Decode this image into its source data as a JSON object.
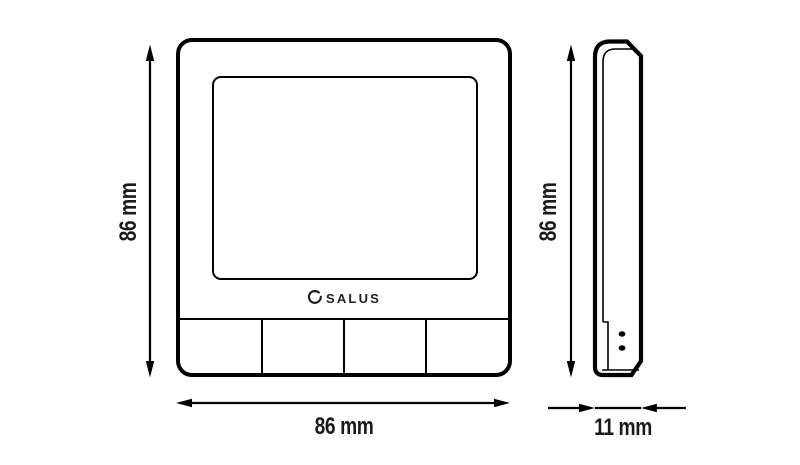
{
  "diagram": {
    "brand": "SALUS",
    "dimensions": {
      "front_height": "86 mm",
      "front_width": "86 mm",
      "side_height": "86 mm",
      "side_depth": "11 mm"
    },
    "front_view": {
      "button_count": 4
    },
    "colors": {
      "line": "#000000",
      "text": "#1b1b1b",
      "background": "#ffffff"
    }
  }
}
